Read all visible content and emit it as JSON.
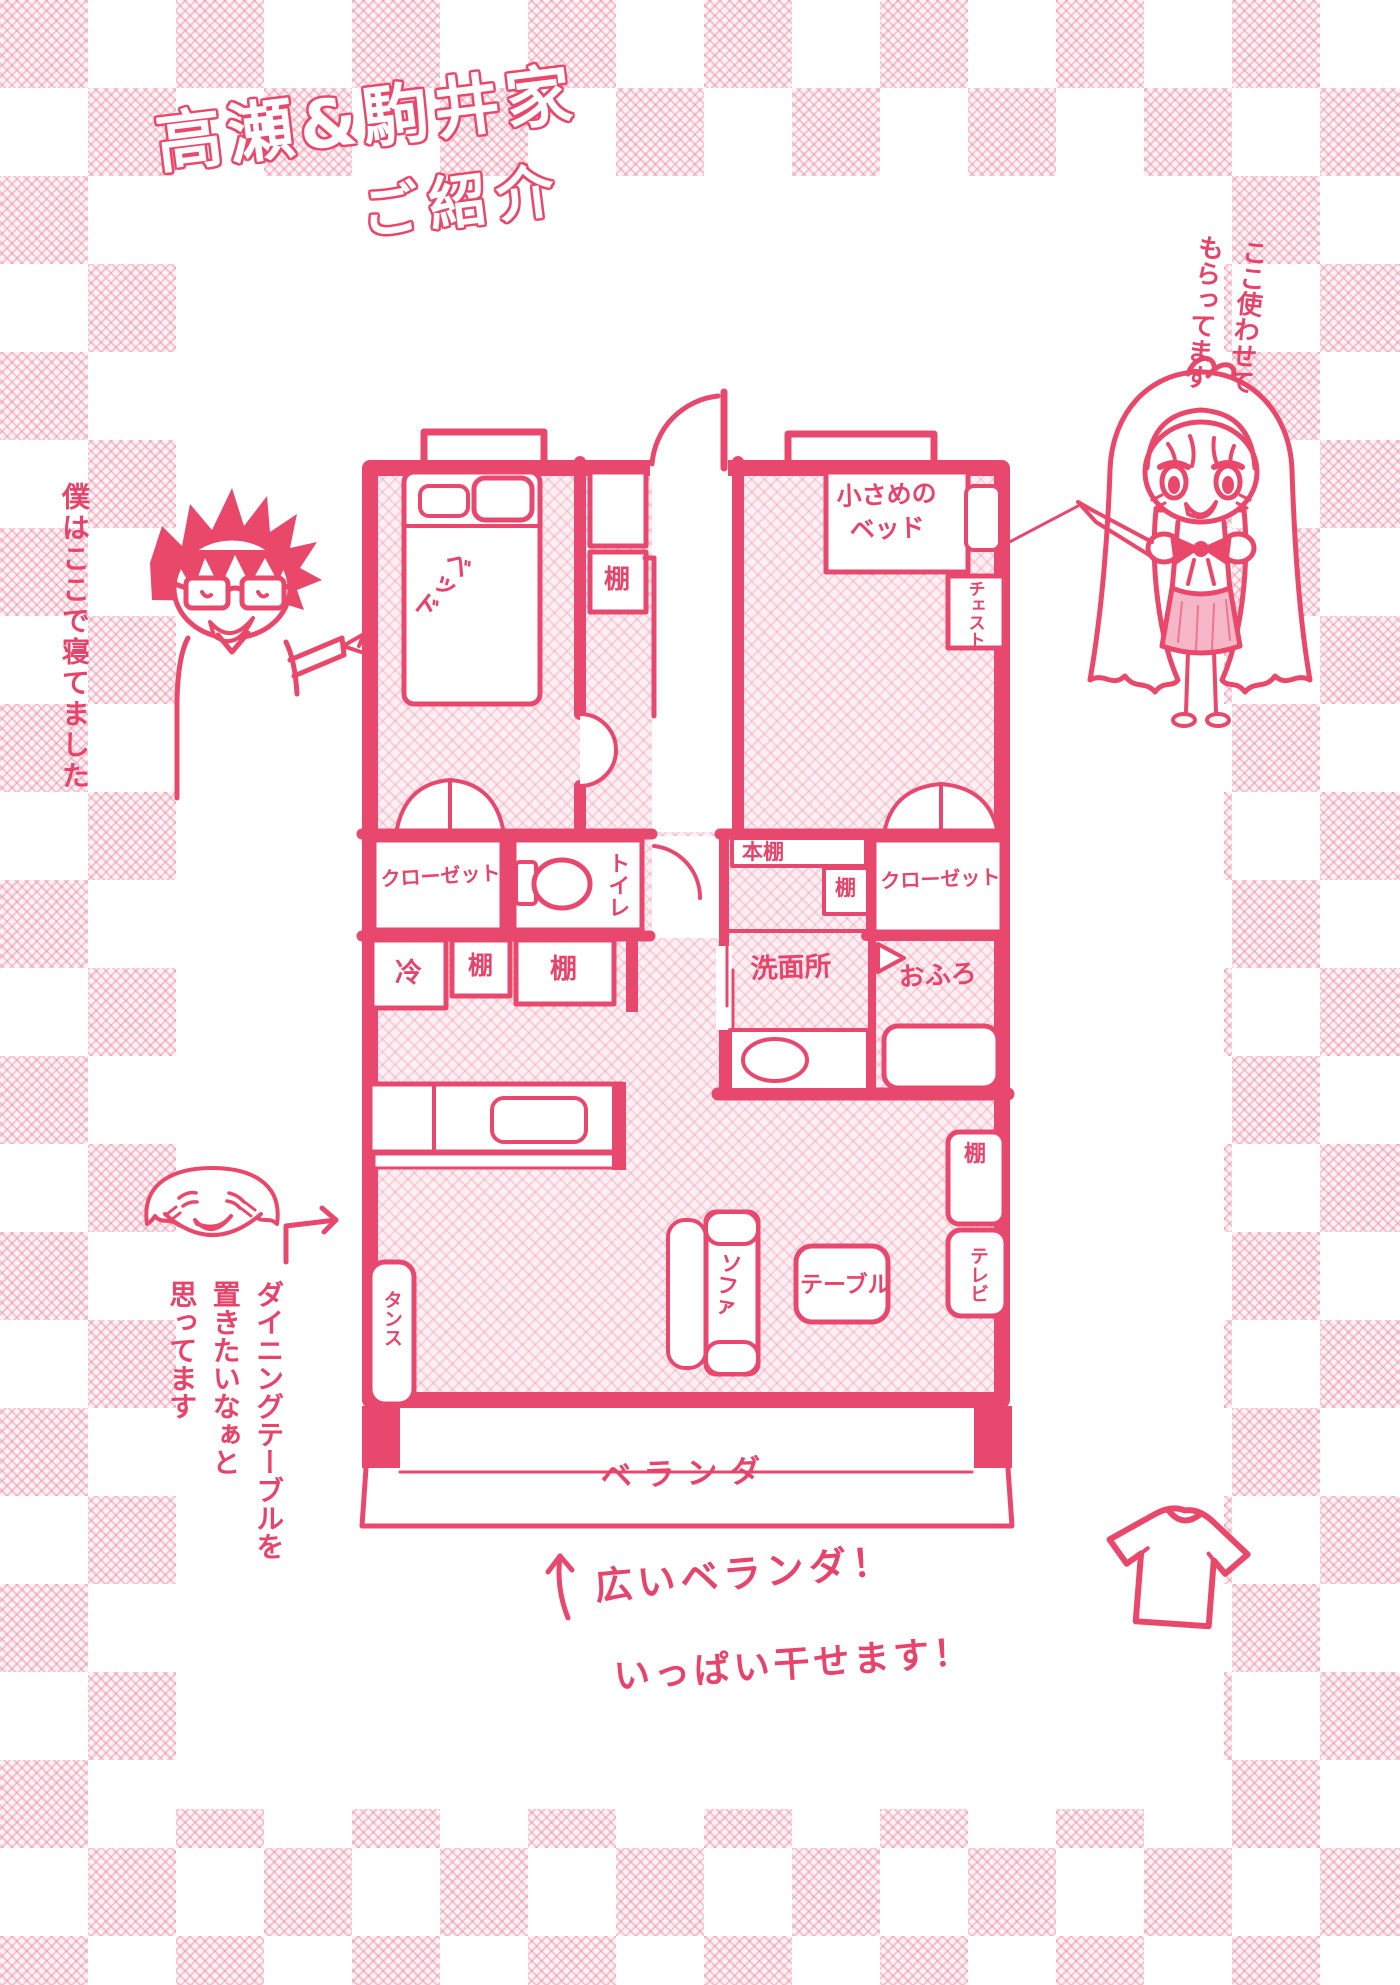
{
  "title": {
    "line1": "高瀬&駒井家",
    "line2": "ご紹介"
  },
  "notes": {
    "girl": [
      "ここ使わせて",
      "もらってます"
    ],
    "boy": "僕はここで寝てました",
    "dining": [
      "ダイニングテーブルを",
      "置きたいなぁと",
      "思ってます"
    ],
    "balcony": [
      "広いベランダ！",
      "いっぱい干せます！"
    ]
  },
  "floorplan": {
    "labels": {
      "bed": "ベッド",
      "hall_shelf": "棚",
      "small_bed": [
        "小さめの",
        "ベッド"
      ],
      "chest": "チェスト",
      "closet_left": "クローゼット",
      "toilet": "トイレ",
      "bookshelf": "本棚",
      "shelf_right": "棚",
      "closet_right": "クローゼット",
      "washroom": "洗面所",
      "bath": "おふろ",
      "fridge": "冷",
      "kitchen_shelf1": "棚",
      "kitchen_shelf2": "棚",
      "tansu": "タンス",
      "sofa": "ソファ",
      "table": "テーブル",
      "tv": "テレビ",
      "living_shelf": "棚",
      "veranda": "ベランダ"
    }
  },
  "colors": {
    "accent": "#e9486b",
    "hatch": "#fdeff3",
    "skirt": "#f5b7c8"
  }
}
